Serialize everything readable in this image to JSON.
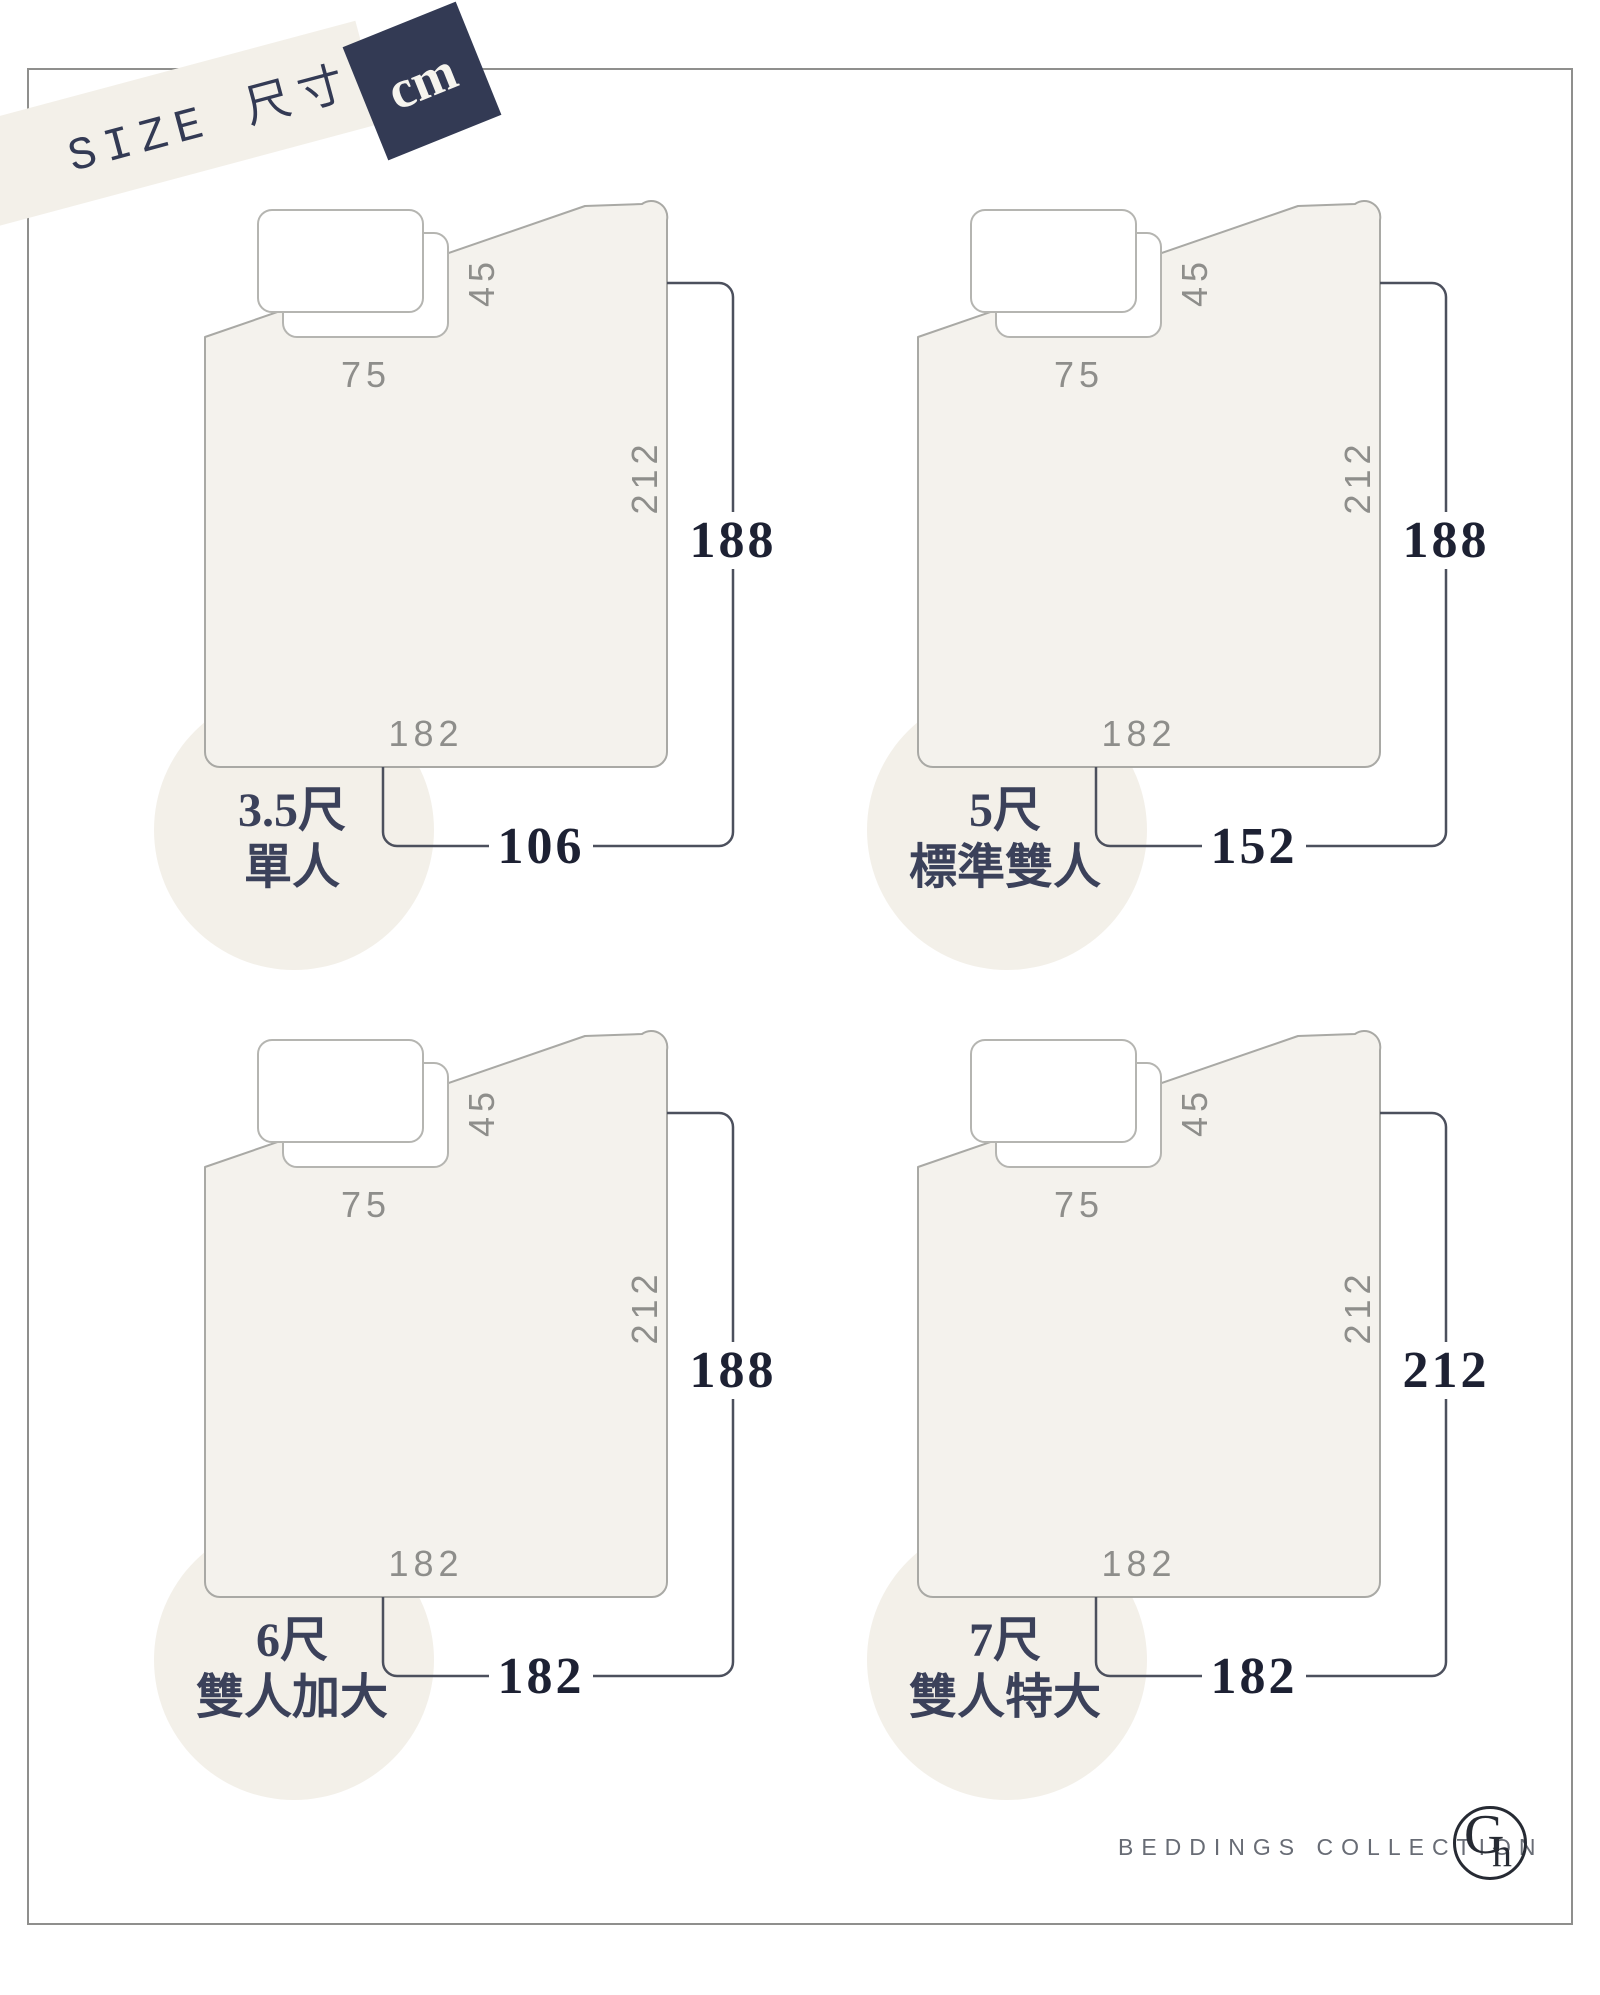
{
  "header": {
    "title": "SIZE 尺寸",
    "unit": "cm"
  },
  "bedding_labels": {
    "pillow_width_cm": "75",
    "pillow_offset_cm": "45",
    "quilt_length_cm": "212",
    "quilt_width_cm": "182"
  },
  "diagrams": [
    {
      "size_ft": "3.5尺",
      "size_name": "單人",
      "mattress_width_cm": "106",
      "mattress_length_cm": "188"
    },
    {
      "size_ft": "5尺",
      "size_name": "標準雙人",
      "mattress_width_cm": "152",
      "mattress_length_cm": "188"
    },
    {
      "size_ft": "6尺",
      "size_name": "雙人加大",
      "mattress_width_cm": "182",
      "mattress_length_cm": "188"
    },
    {
      "size_ft": "7尺",
      "size_name": "雙人特大",
      "mattress_width_cm": "182",
      "mattress_length_cm": "212"
    }
  ],
  "footer": {
    "brand": "BEDDINGS COLLECTION",
    "logo_letter_g": "G",
    "logo_letter_n": "n"
  },
  "colors": {
    "navy": "#333a54",
    "cream": "#f3f0e9",
    "quilt_fill": "#f4f2ed",
    "outline_gray": "#a9a9a5",
    "label_gray": "#8e8e8b",
    "dimension_line": "#4c505d",
    "number_dark": "#1d2133"
  }
}
